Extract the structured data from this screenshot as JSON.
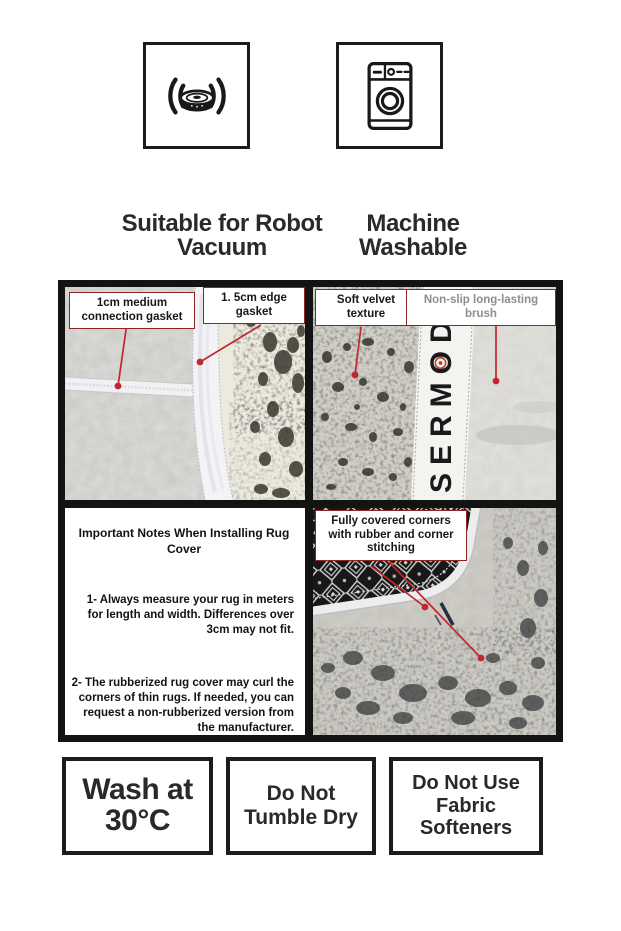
{
  "colors": {
    "leader_red": "#c1272d",
    "callout_border": "#90241f",
    "text_dark": "#2b292b",
    "text_gray": "#8e8e91",
    "frame_black": "#131313"
  },
  "top_badges": [
    {
      "icon": "robot-vacuum-icon",
      "caption_lines": [
        "Suitable for Robot",
        "Vacuum"
      ]
    },
    {
      "icon": "washing-machine-icon",
      "caption_lines": [
        "Machine",
        "Washable"
      ]
    }
  ],
  "gasket_panel": {
    "label_connection": "1cm medium connection gasket",
    "label_edge": "1. 5cm edge gasket"
  },
  "texture_panel": {
    "label_velvet": "Soft velvet texture",
    "label_brush": "Non-slip long-lasting brush",
    "brand": "SERMOD"
  },
  "notes_panel": {
    "title": "Important Notes When Installing Rug Cover",
    "items": [
      "1- Always measure your rug in meters for length and width. Differences over 3cm may not fit.",
      "2- The rubberized rug cover may curl the corners of thin rugs. If needed, you can request a non-rubberized version from the manufacturer."
    ]
  },
  "corner_panel": {
    "label": "Fully covered corners with rubber and corner stitching"
  },
  "care_boxes": [
    {
      "lines": [
        "Wash at",
        "30°C"
      ]
    },
    {
      "lines": [
        "Do Not",
        "Tumble Dry"
      ]
    },
    {
      "lines": [
        "Do Not Use",
        "Fabric",
        "Softeners"
      ]
    }
  ]
}
